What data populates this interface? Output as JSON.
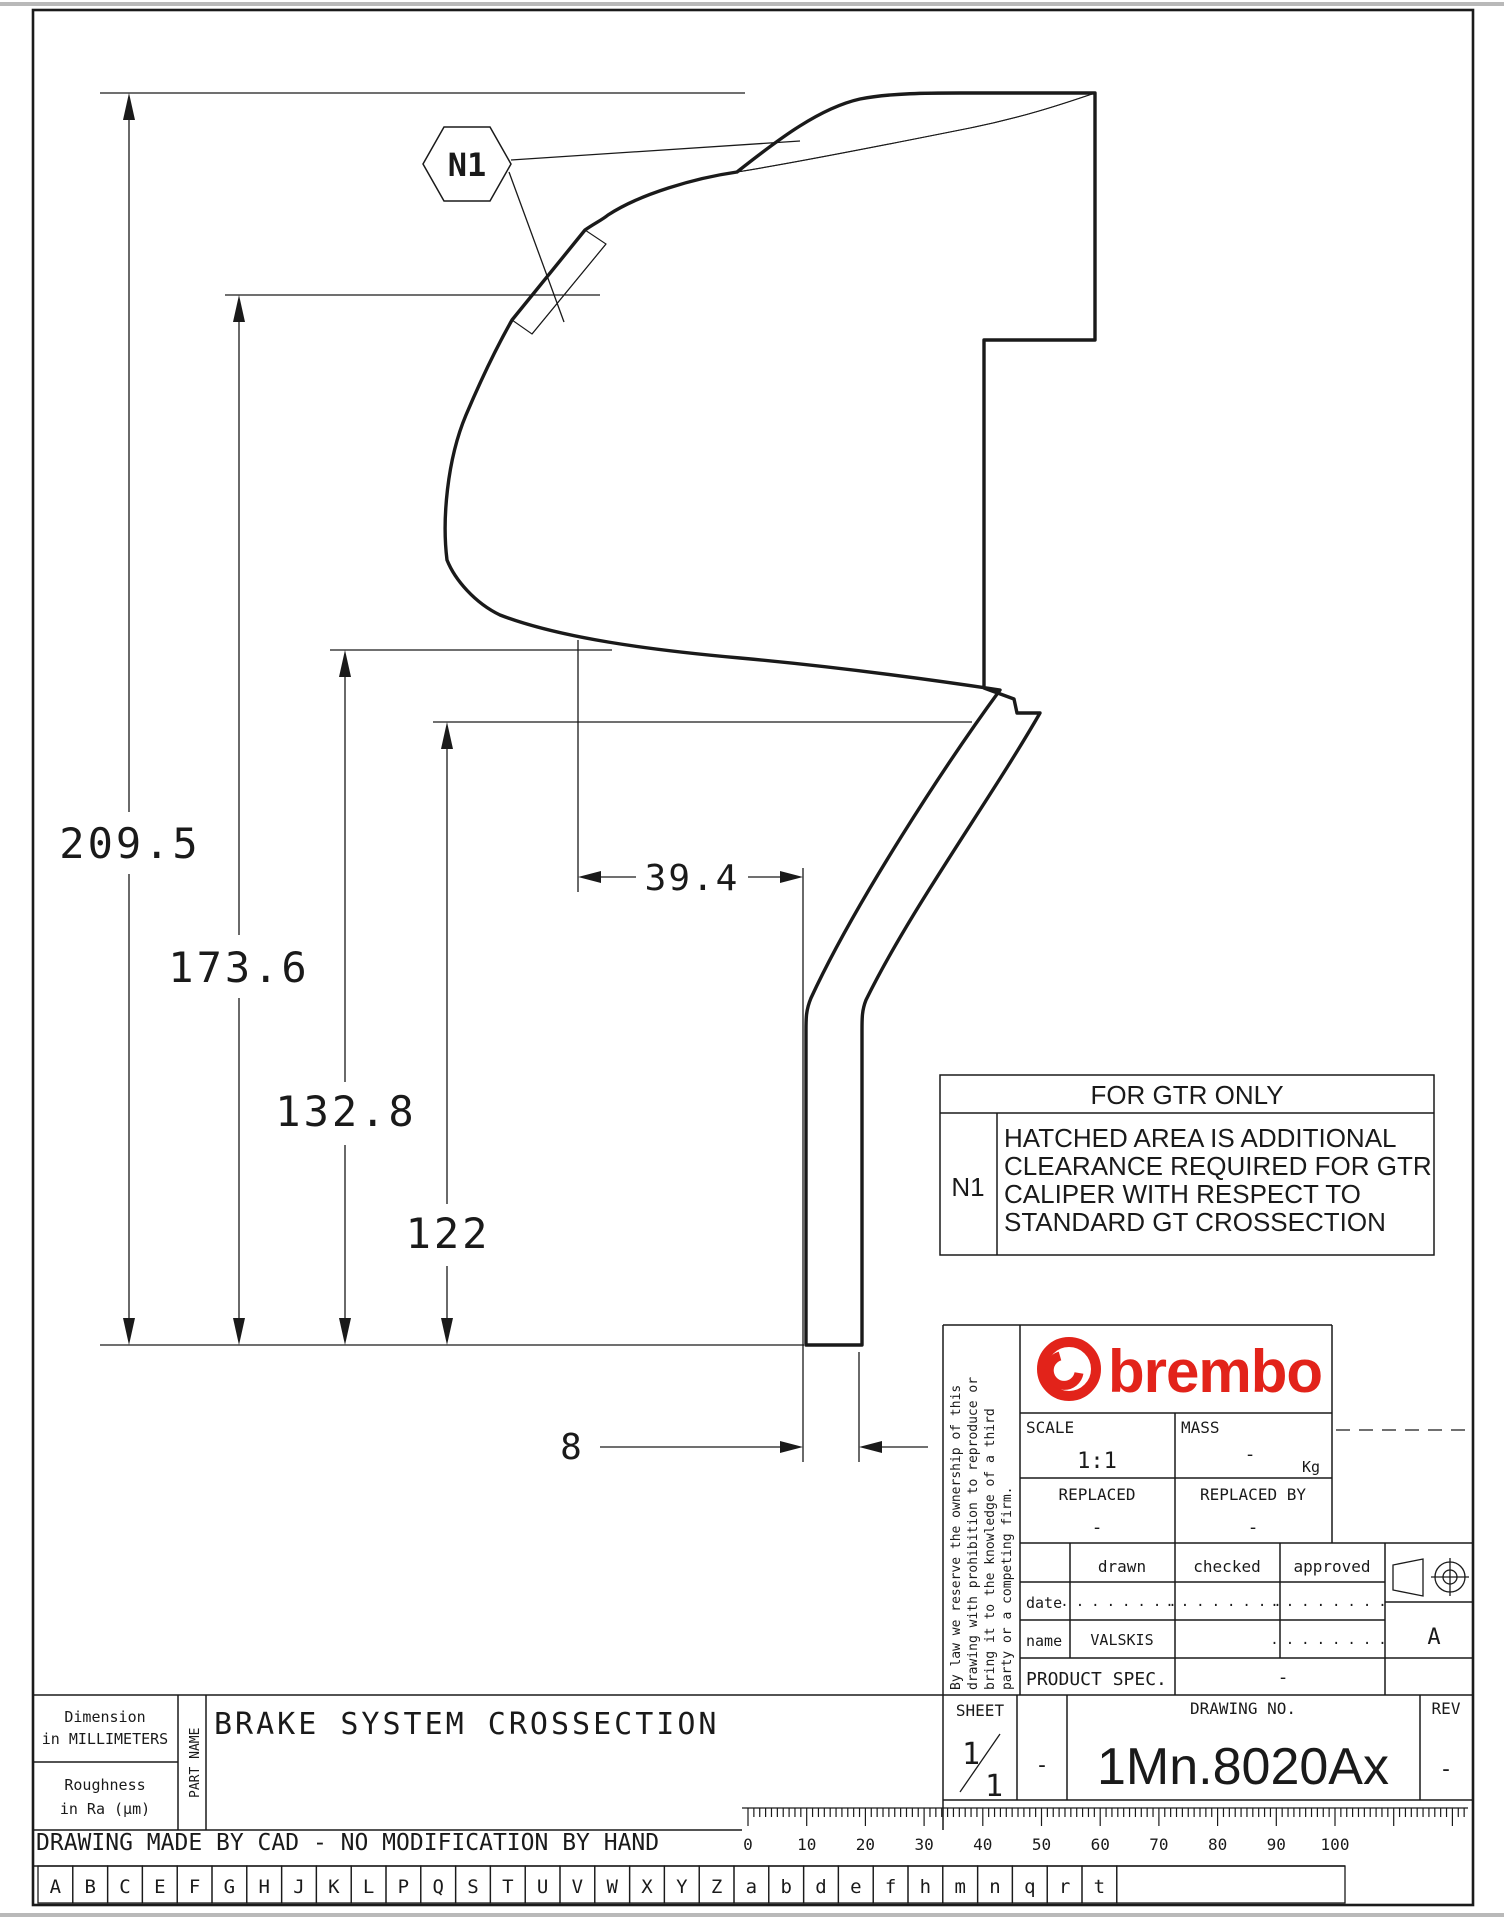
{
  "page": {
    "background": "#ffffff",
    "ink": "#1a1a1a",
    "accent_red": "#e2231a"
  },
  "dims": {
    "h209": "209.5",
    "h173": "173.6",
    "h132": "132.8",
    "h122": "122",
    "w39": "39.4",
    "w8": "8"
  },
  "callout": {
    "label": "N1"
  },
  "note": {
    "title": "FOR GTR ONLY",
    "tag": "N1",
    "line1": "HATCHED AREA IS ADDITIONAL",
    "line2": "CLEARANCE REQUIRED FOR GTR",
    "line3": "CALIPER WITH RESPECT TO",
    "line4": "STANDARD GT CROSSECTION"
  },
  "titleblock": {
    "legal1": "By law we reserve the ownership of this",
    "legal2": "drawing with prohibition to reproduce or",
    "legal3": "bring it to the knowledge of a third",
    "legal4": "party or a competing firm.",
    "brand": "brembo",
    "scale_label": "SCALE",
    "scale_value": "1:1",
    "mass_label": "MASS",
    "mass_value": "-",
    "mass_unit": "Kg",
    "replaced_label": "REPLACED",
    "replaced_value": "-",
    "replaced_by_label": "REPLACED BY",
    "replaced_by_value": "-",
    "col_drawn": "drawn",
    "col_checked": "checked",
    "col_approved": "approved",
    "row_date": "date",
    "row_name": "name",
    "dots": "........",
    "name_drawn": "VALSKIS",
    "product_spec_label": "PRODUCT SPEC.",
    "product_spec_value": "-",
    "sheet_label": "SHEET",
    "sheet_num": "1",
    "sheet_den": "1",
    "sheet_dash": "-",
    "drawing_no_label": "DRAWING NO.",
    "drawing_no": "1Mn.8020Ax",
    "rev_label": "REV",
    "rev_value": "-",
    "format_letter": "A"
  },
  "footer": {
    "dim_note1": "Dimension",
    "dim_note2": "in MILLIMETERS",
    "rough_note1": "Roughness",
    "rough_note2": "in Ra (µm)",
    "part_name_label": "PART NAME",
    "part_title": "BRAKE SYSTEM CROSSECTION",
    "cad_note": "DRAWING MADE BY CAD - NO MODIFICATION BY HAND",
    "ruler": {
      "start": 0,
      "end": 100,
      "step": 10,
      "x0": 748,
      "px_per_step": 58.7,
      "y": 1808
    },
    "zone_letters": [
      "A",
      "B",
      "C",
      "E",
      "F",
      "G",
      "H",
      "J",
      "K",
      "L",
      "P",
      "Q",
      "S",
      "T",
      "U",
      "V",
      "W",
      "X",
      "Y",
      "Z",
      "a",
      "b",
      "d",
      "e",
      "f",
      "h",
      "m",
      "n",
      "q",
      "r",
      "t"
    ]
  }
}
